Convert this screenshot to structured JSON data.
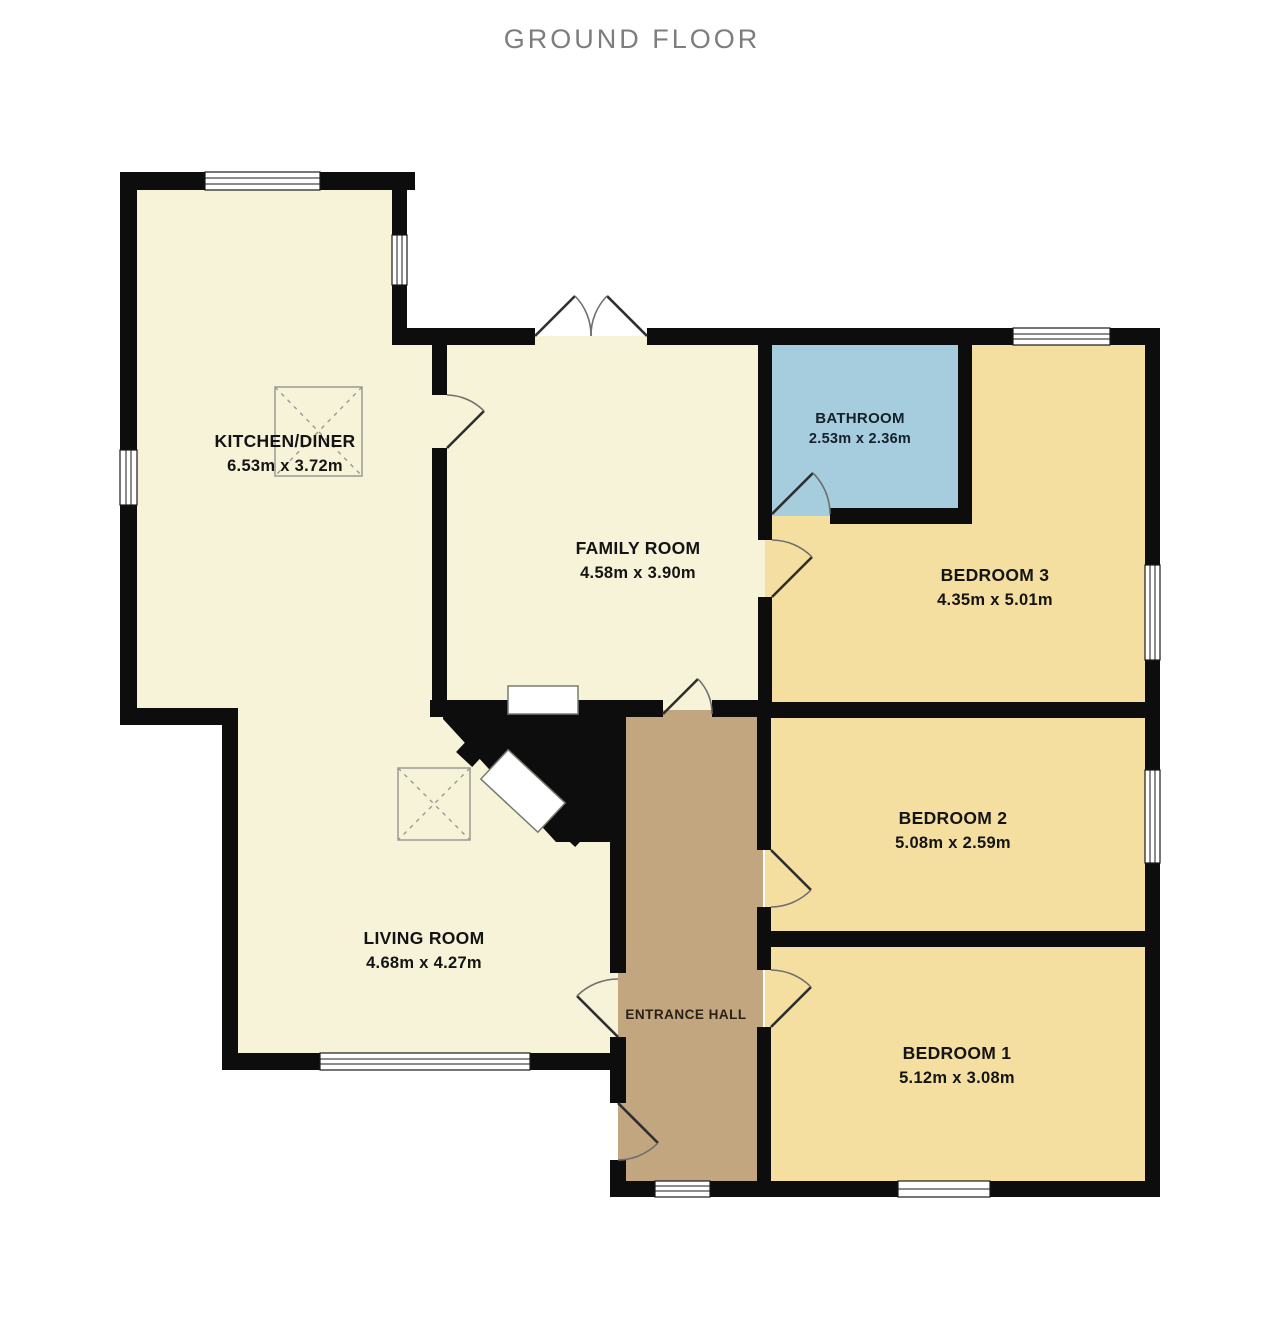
{
  "title": "GROUND FLOOR",
  "colors": {
    "cream": "#f7f3d8",
    "bedroom": "#f4dfa0",
    "bathroom": "#a6cdde",
    "hall": "#c1a67f",
    "wall": "#0d0d0d"
  },
  "rooms": {
    "kitchen": {
      "name": "KITCHEN/DINER",
      "dims": "6.53m x 3.72m"
    },
    "family": {
      "name": "FAMILY ROOM",
      "dims": "4.58m x 3.90m"
    },
    "bathroom": {
      "name": "BATHROOM",
      "dims": "2.53m x 2.36m"
    },
    "bedroom3": {
      "name": "BEDROOM 3",
      "dims": "4.35m x 5.01m"
    },
    "bedroom2": {
      "name": "BEDROOM 2",
      "dims": "5.08m x 2.59m"
    },
    "bedroom1": {
      "name": "BEDROOM 1",
      "dims": "5.12m x 3.08m"
    },
    "living": {
      "name": "LIVING ROOM",
      "dims": "4.68m x 4.27m"
    },
    "hall": {
      "name": "ENTRANCE HALL"
    }
  }
}
